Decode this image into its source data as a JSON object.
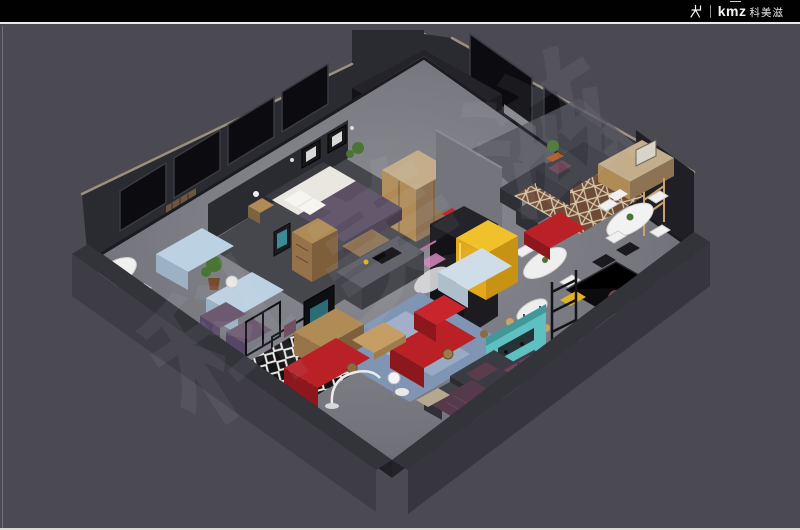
{
  "header": {
    "brand_latin": "kmz",
    "brand_cn": "科美滋",
    "logo_icon": "chair-icon"
  },
  "watermark": {
    "text": "科美滋"
  },
  "scene_alt": "Isometric 3D cutaway render of a furniture showroom floor plan",
  "colors": {
    "canvas_bg": "#4b4a53",
    "topbar_bg": "#010101",
    "topbar_line": "#e9e9e9",
    "bottom_line": "#dcdcd6",
    "edge_line": "#8a8992",
    "wall_dark": "#2a2a31",
    "wall_darker": "#1f1f25",
    "window_glass": "#0c0c10",
    "window_frame": "#3a3a42",
    "wall_top_edge": "#9b8f7e",
    "block_top": "#232329",
    "block_left": "#131317",
    "block_right": "#1b1b20",
    "floor_dark": "#46464d",
    "concrete": "#74747c",
    "parapet_inner": "#1f1f24",
    "parapet_top": "#33333a",
    "parapet_outer": "#3e3d45",
    "wood": "#b08b56",
    "wood_light": "#c4ad8a",
    "wood_dark": "#8d7354",
    "sofa_red": "#b92127",
    "sofa_red_dark": "#8c181d",
    "armchair_red": "#c8262c",
    "sofa_blue": "#bcd1e2",
    "sofa_blue_dark": "#9cb2c4",
    "rug_blue": "#8095b4",
    "rug_blue_light": "#b7c3d6",
    "teal": "#5fc0c1",
    "teal_dark": "#3f9899",
    "yellow": "#f1c12c",
    "yellow_dark": "#c89212",
    "pink": "#d583b8",
    "plum": "#553a4c",
    "plum_light": "#6b4456",
    "dark_sofa": "#3b3b43",
    "white": "#f0f0f0",
    "green": "#4a7534",
    "pot_orange": "#b05a26",
    "black_table": "#0c0c0f",
    "chair_yellow": "#e2b322",
    "purple_chair": "#6d5a70"
  }
}
